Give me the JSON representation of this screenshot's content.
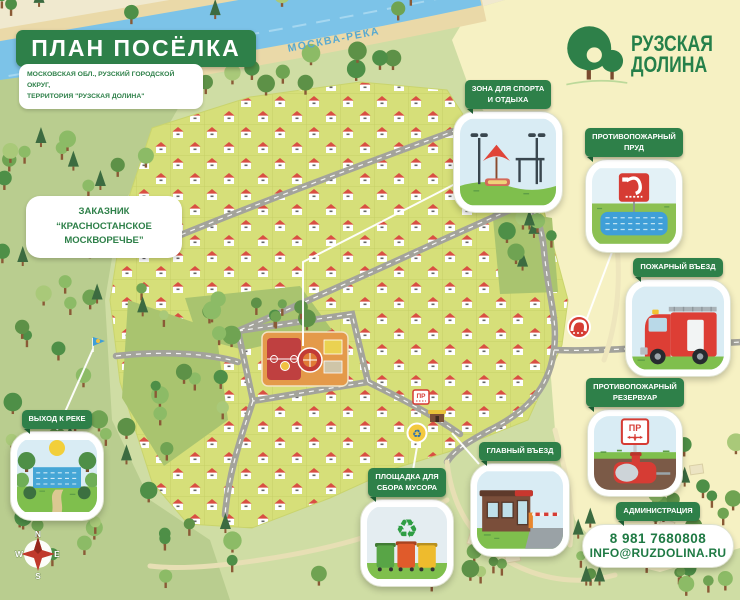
{
  "header": {
    "title": "ПЛАН ПОСЁЛКА",
    "subtitle": "МОСКОВСКАЯ ОБЛ., РУЗСКИЙ ГОРОДСКОЙ ОКРУГ,\nТЕРРИТОРИЯ \"РУЗСКАЯ ДОЛИНА\""
  },
  "logo": {
    "line1": "РУЗСКАЯ",
    "line2": "ДОЛИНА"
  },
  "map": {
    "river_label": "МОСКВА-РЕКА",
    "reserve_label": "ЗАКАЗНИК\n“КРАСНОСТАНСКОЕ\nМОСКВОРЕЧЬЕ”",
    "pr_sign": "ПР"
  },
  "callouts": {
    "sport": {
      "label": "ЗОНА ДЛЯ СПОРТА\nИ ОТДЫХА"
    },
    "fire_pond": {
      "label": "ПРОТИВОПОЖАРНЫЙ\nПРУД"
    },
    "fire_entrance": {
      "label": "ПОЖАРНЫЙ ВЪЕЗД"
    },
    "fire_reservoir": {
      "label": "ПРОТИВОПОЖАРНЫЙ\nРЕЗЕРВУАР",
      "sign_text": "ПР"
    },
    "main_entrance": {
      "label": "ГЛАВНЫЙ ВЪЕЗД"
    },
    "trash": {
      "label": "ПЛОЩАДКА ДЛЯ\nСБОРА МУСОРА"
    },
    "river_exit": {
      "label": "ВЫХОД К РЕКЕ"
    },
    "administration": {
      "label": "АДМИНИСТРАЦИЯ",
      "phone": "8 981 7680808",
      "email": "INFO@RUZDOLINA.RU"
    }
  },
  "compass": {
    "n": "N",
    "e": "E",
    "s": "S",
    "w": "W"
  },
  "icons": {
    "recycle": "♻"
  },
  "colors": {
    "brand_green": "#2e8049",
    "river_blue": "#7cc3e8",
    "map_green": "#d6df79",
    "accent_red": "#d63c34"
  }
}
